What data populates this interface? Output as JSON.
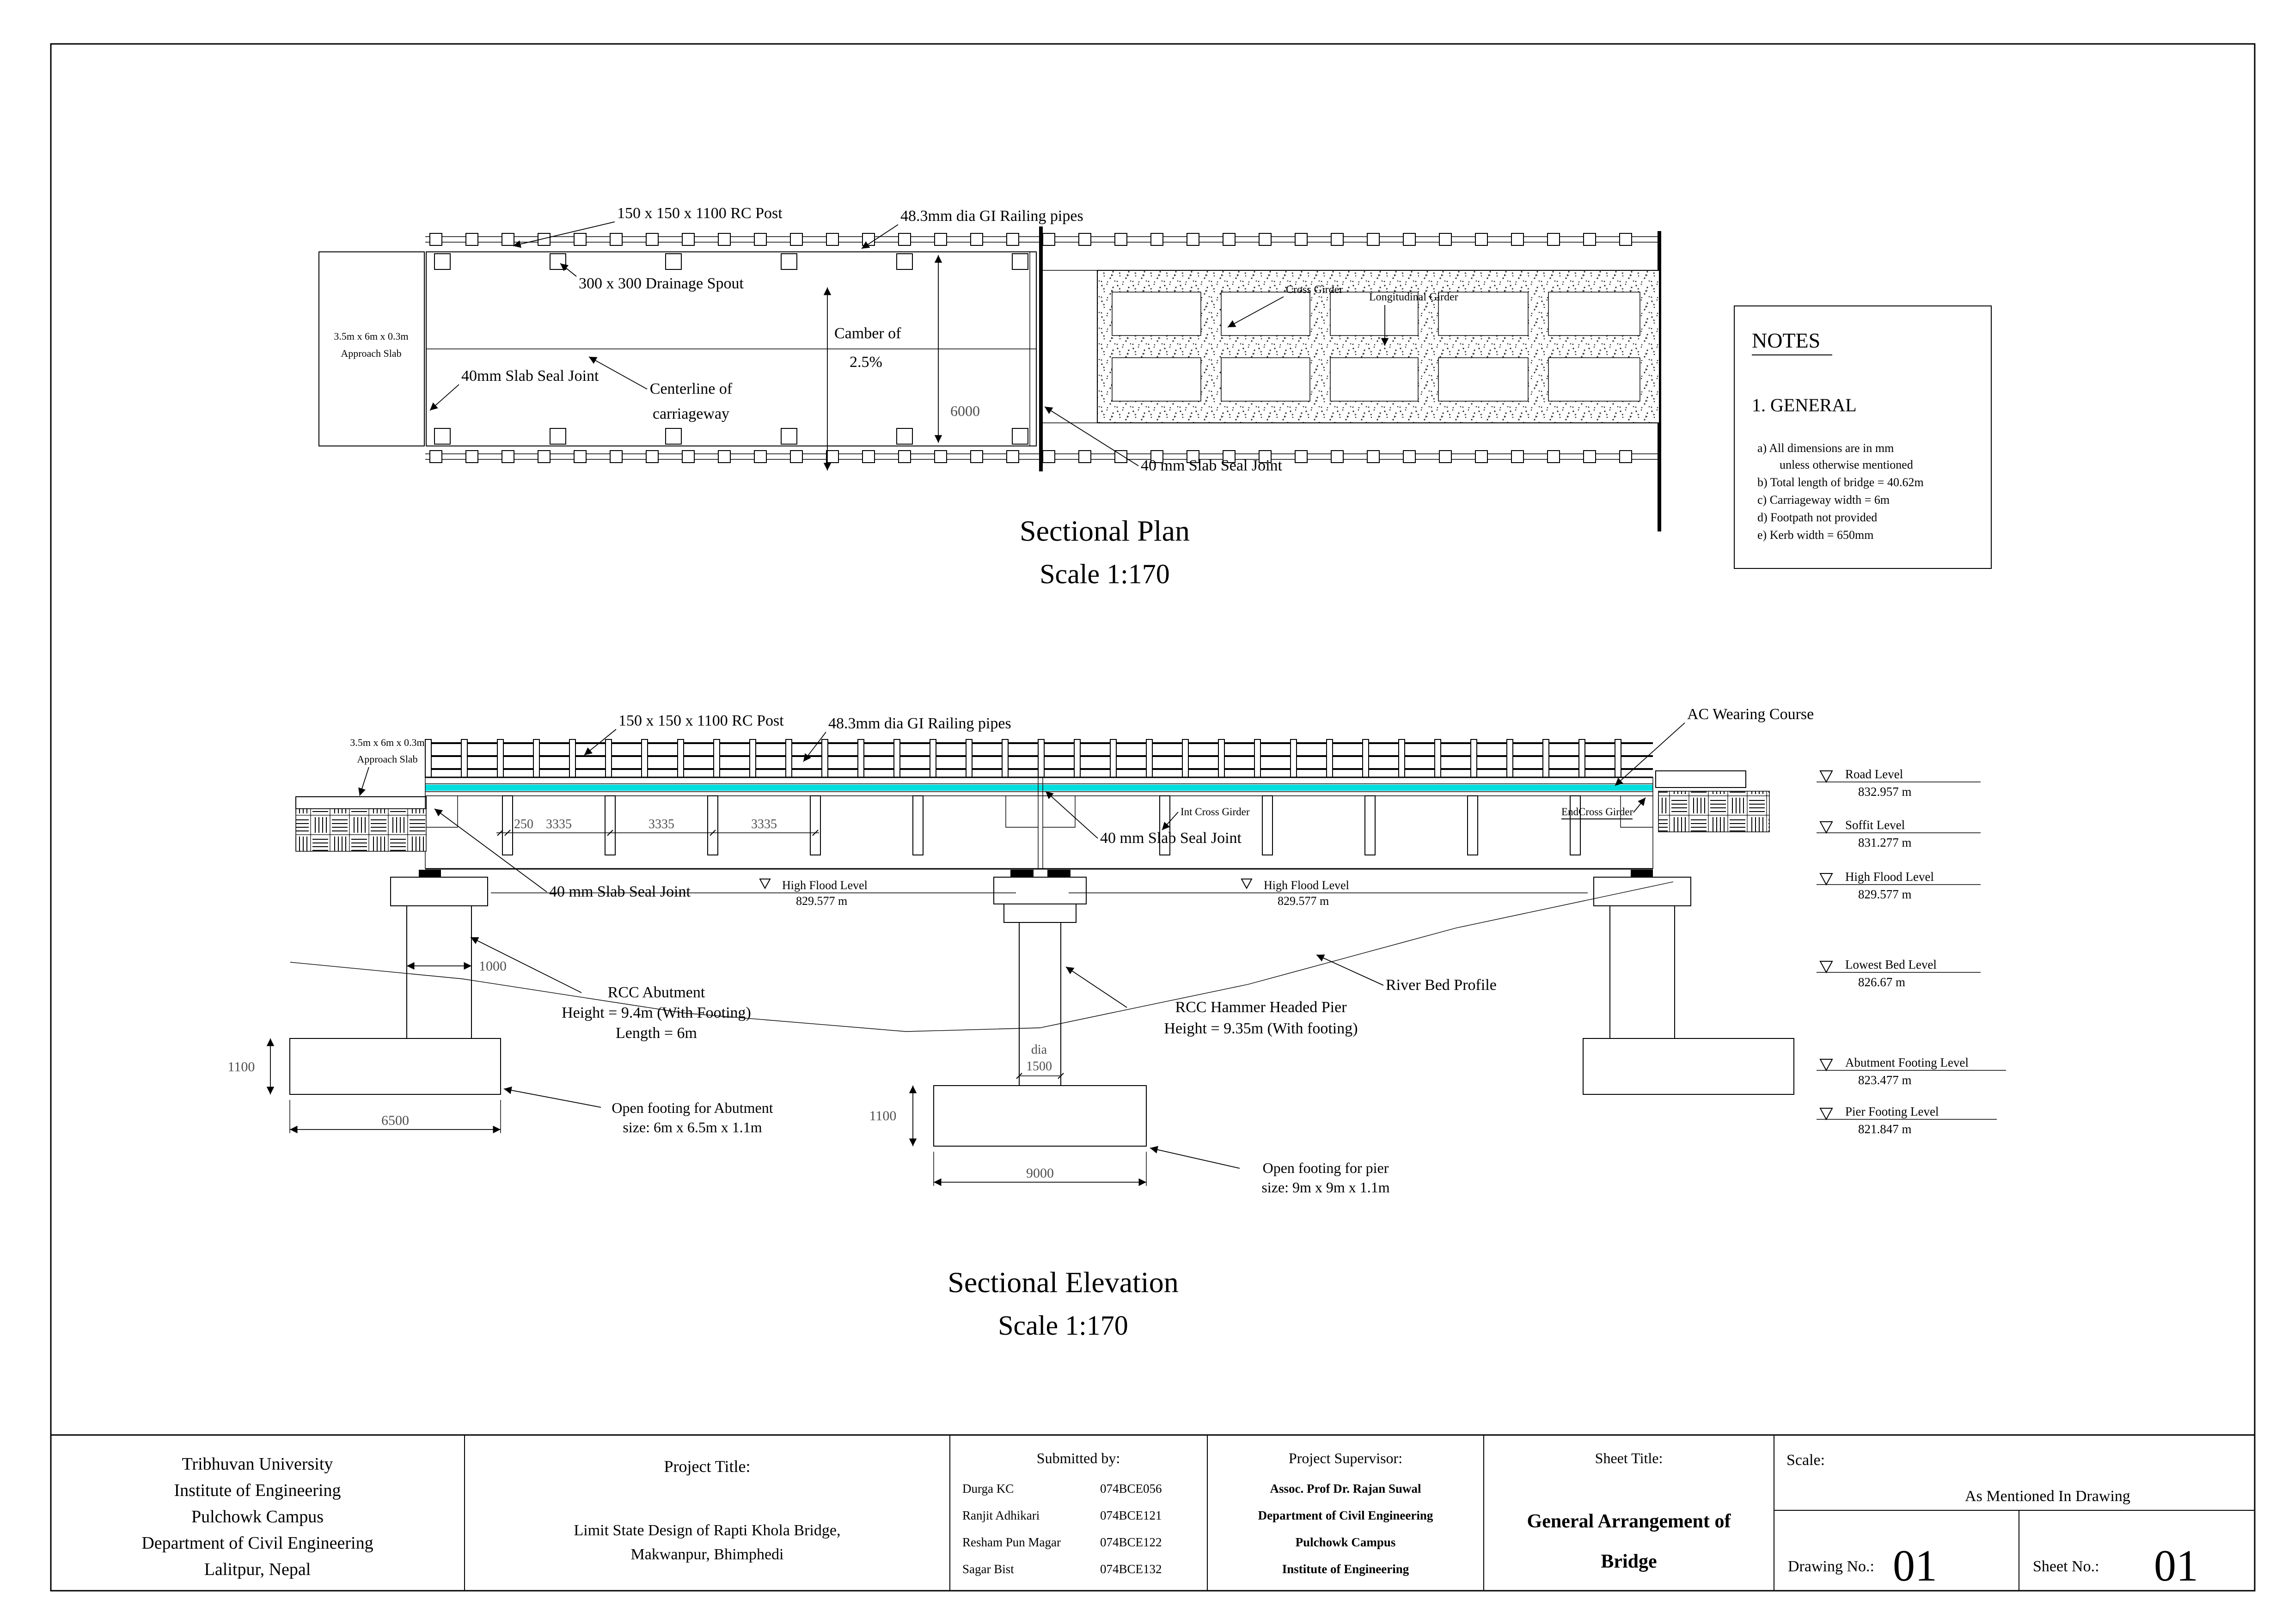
{
  "page": {
    "background": "#ffffff",
    "line_color": "#000000",
    "wearing_course_color": "#00dfe0"
  },
  "plan": {
    "title": "Sectional Plan",
    "scale": "Scale 1:170",
    "labels": {
      "rc_post": "150 x 150 x 1100 RC Post",
      "railing_pipes": "48.3mm dia GI Railing pipes",
      "drainage_spout": "300 x 300 Drainage Spout",
      "camber_line1": "Camber of",
      "camber_line2": "2.5%",
      "slab_seal_left": "40mm Slab Seal Joint",
      "centerline_line1": "Centerline of",
      "centerline_line2": "carriageway",
      "slab_seal_right": "40 mm Slab Seal Joint",
      "cross_girder": "Cross Girder",
      "longitudinal_girder": "Longitudinal Girder",
      "approach_line1": "3.5m x 6m x 0.3m",
      "approach_line2": "Approach Slab",
      "deck_width_dim": "6000"
    }
  },
  "elevation": {
    "title": "Sectional Elevation",
    "scale": "Scale 1:170",
    "labels": {
      "rc_post": "150 x 150 x 1100 RC Post",
      "railing_pipes": "48.3mm dia GI Railing pipes",
      "ac_wearing": "AC Wearing Course",
      "approach_line1": "3.5m x 6m x 0.3m",
      "approach_line2": "Approach Slab",
      "slab_seal_pier": "40 mm Slab Seal Joint",
      "slab_seal_abutment": "40 mm Slab Seal Joint",
      "int_cross_girder": "Int Cross Girder",
      "end_cross_girder": "EndCross Girder",
      "high_flood_level": "High Flood Level",
      "high_flood_value": "829.577 m",
      "river_bed": "River Bed Profile",
      "abutment_line1": "RCC Abutment",
      "abutment_line2": "Height = 9.4m (With Footing)",
      "abutment_line3": "Length = 6m",
      "pier_line1": "RCC Hammer Headed Pier",
      "pier_line2": "Height = 9.35m (With footing)",
      "abutment_footing_line1": "Open footing for Abutment",
      "abutment_footing_line2": "size: 6m x 6.5m x 1.1m",
      "pier_footing_line1": "Open footing for pier",
      "pier_footing_line2": "size: 9m x 9m x 1.1m",
      "dia_label": "dia",
      "dia_value": "1500"
    },
    "dims": {
      "girder_start": "250",
      "girder_spacing": "3335",
      "abutment_stem": "1000",
      "abutment_footing_depth": "1100",
      "abutment_footing_width": "6500",
      "pier_footing_depth": "1100",
      "pier_footing_width": "9000"
    }
  },
  "levels": {
    "items": [
      {
        "label": "Road Level",
        "value": "832.957 m"
      },
      {
        "label": "Soffit Level",
        "value": "831.277 m"
      },
      {
        "label": "High Flood Level",
        "value": "829.577 m"
      },
      {
        "label": "Lowest Bed Level",
        "value": "826.67 m"
      },
      {
        "label": "Abutment Footing Level",
        "value": "823.477 m"
      },
      {
        "label": "Pier Footing Level",
        "value": "821.847 m"
      }
    ]
  },
  "notes": {
    "heading": "NOTES",
    "section": "1. GENERAL",
    "items": [
      "a) All dimensions are in mm",
      "unless otherwise mentioned",
      "b) Total length of bridge = 40.62m",
      "c) Carriageway width = 6m",
      "d) Footpath not provided",
      "e) Kerb width = 650mm"
    ]
  },
  "title_block": {
    "university_lines": [
      "Tribhuvan University",
      "Institute of Engineering",
      "Pulchowk Campus",
      "Department of Civil Engineering",
      "Lalitpur, Nepal"
    ],
    "project_title_label": "Project Title:",
    "project_title_lines": [
      "Limit State Design of Rapti Khola Bridge,",
      "Makwanpur, Bhimphedi"
    ],
    "submitted_label": "Submitted by:",
    "submitted": [
      {
        "name": "Durga KC",
        "roll": "074BCE056"
      },
      {
        "name": "Ranjit Adhikari",
        "roll": "074BCE121"
      },
      {
        "name": "Resham Pun Magar",
        "roll": "074BCE122"
      },
      {
        "name": "Sagar Bist",
        "roll": "074BCE132"
      }
    ],
    "supervisor_label": "Project Supervisor:",
    "supervisor_lines": [
      "Assoc. Prof Dr. Rajan Suwal",
      "Department of Civil Engineering",
      "Pulchowk Campus",
      "Institute of Engineering"
    ],
    "sheet_title_label": "Sheet Title:",
    "sheet_title_lines": [
      "General Arrangement of",
      "Bridge"
    ],
    "scale_label": "Scale:",
    "scale_value": "As Mentioned In Drawing",
    "drawing_no_label": "Drawing No.:",
    "drawing_no": "01",
    "sheet_no_label": "Sheet No.:",
    "sheet_no": "01"
  }
}
